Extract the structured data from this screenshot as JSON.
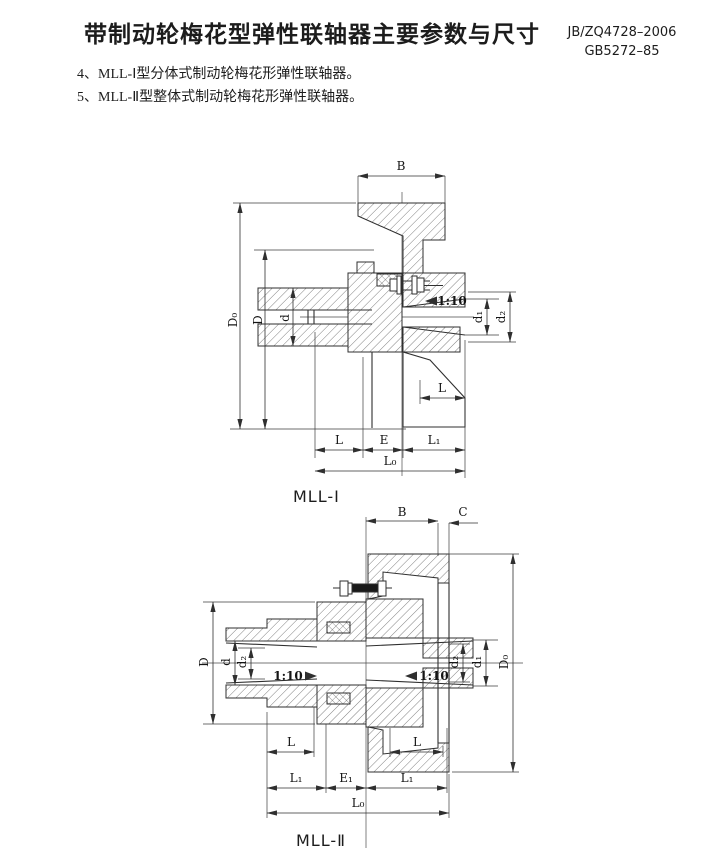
{
  "page": {
    "title": "带制动轮梅花型弹性联轴器主要参数与尺寸",
    "standards": [
      "JB/ZQ4728–2006",
      "GB5272–85"
    ],
    "items": [
      "4、MLL-Ⅰ型分体式制动轮梅花形弹性联轴器。",
      "5、MLL-Ⅱ型整体式制动轮梅花形弹性联轴器。"
    ]
  },
  "figures": [
    {
      "caption": "MLL-Ⅰ",
      "dims": {
        "B": "B",
        "D0": "D₀",
        "D": "D",
        "d": "d",
        "d1": "d₁",
        "d2": "d₂",
        "taper": "1:10",
        "L_side": "L",
        "L": "L",
        "E": "E",
        "L1": "L₁",
        "L0": "L₀"
      }
    },
    {
      "caption": "MLL-Ⅱ",
      "dims": {
        "B": "B",
        "C": "C",
        "D0": "D₀",
        "D": "D",
        "d": "d",
        "d2_left": "d₂",
        "d1": "d₁",
        "d2_right": "d₂",
        "taper_left": "1:10",
        "taper_right": "1:10",
        "L_left": "L",
        "L_right": "L",
        "L1_left": "L₁",
        "E1": "E₁",
        "L1_right": "L₁",
        "L0": "L₀"
      }
    }
  ],
  "colors": {
    "ink": "#2f2f2f",
    "paper": "#ffffff"
  }
}
